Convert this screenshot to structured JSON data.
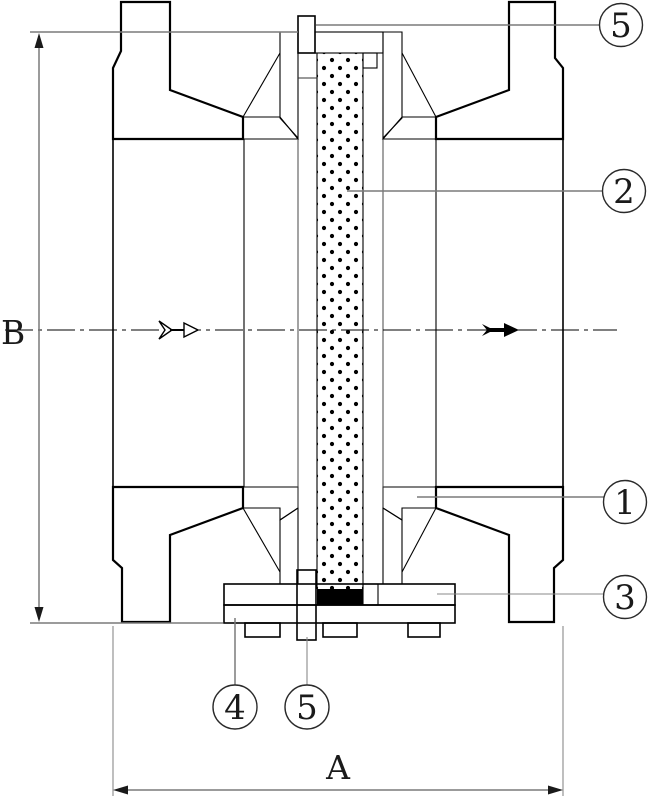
{
  "drawing": {
    "kind": "valve-cross-section",
    "dimension_labels": {
      "horizontal": "A",
      "vertical": "B"
    },
    "callouts": {
      "top_screw": "5",
      "element": "2",
      "body": "1",
      "cover": "3",
      "plate": "4",
      "bottom_screw": "5"
    },
    "colors": {
      "body_fill": "#d2d2d2",
      "guide_fill": "#ababab",
      "seal_fill": "#000000",
      "white_fill": "#ffffff",
      "outline": "#000000",
      "dimension_line": "#7a7a7a"
    }
  }
}
